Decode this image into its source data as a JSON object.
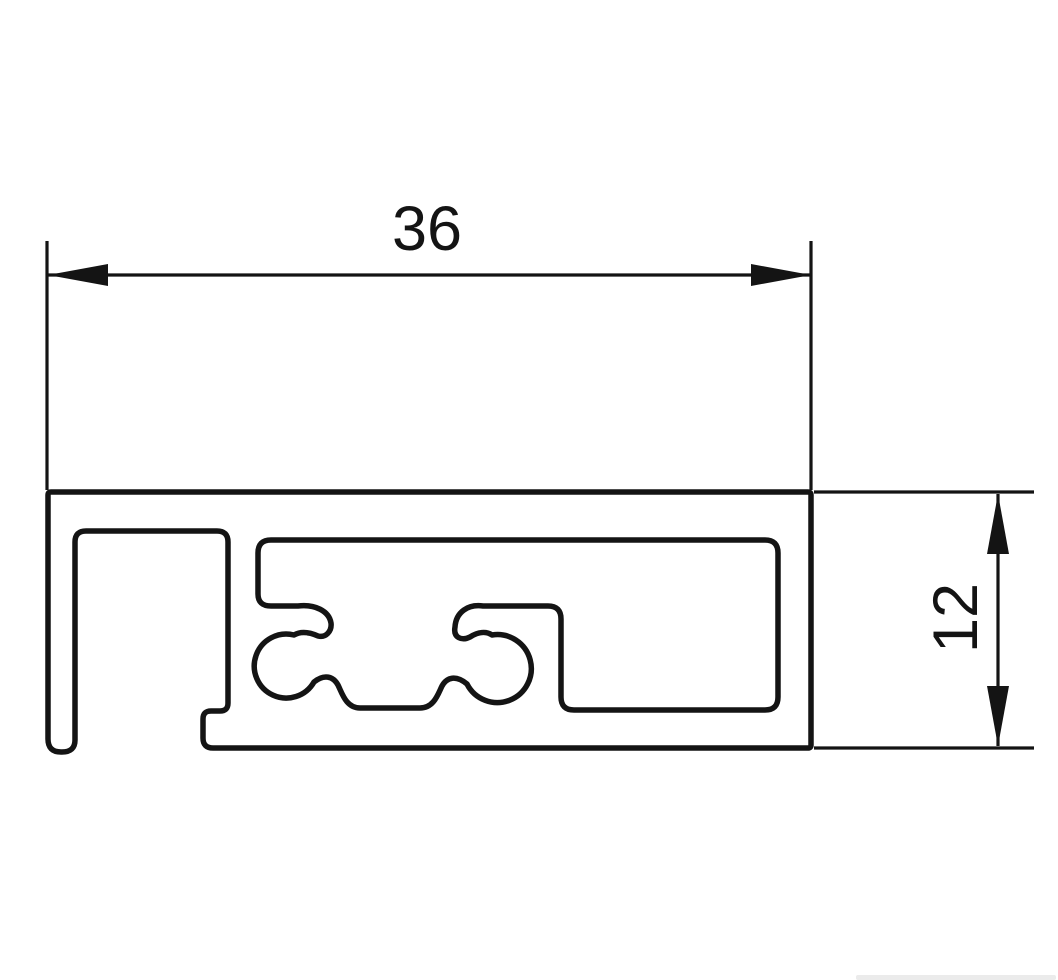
{
  "drawing": {
    "type": "technical cross-section drawing of an extrusion profile",
    "background": "#ffffff",
    "line_color": "#141414",
    "dimensions": {
      "width": {
        "label": "36",
        "orientation": "horizontal"
      },
      "height": {
        "label": "12",
        "orientation": "vertical"
      }
    }
  }
}
